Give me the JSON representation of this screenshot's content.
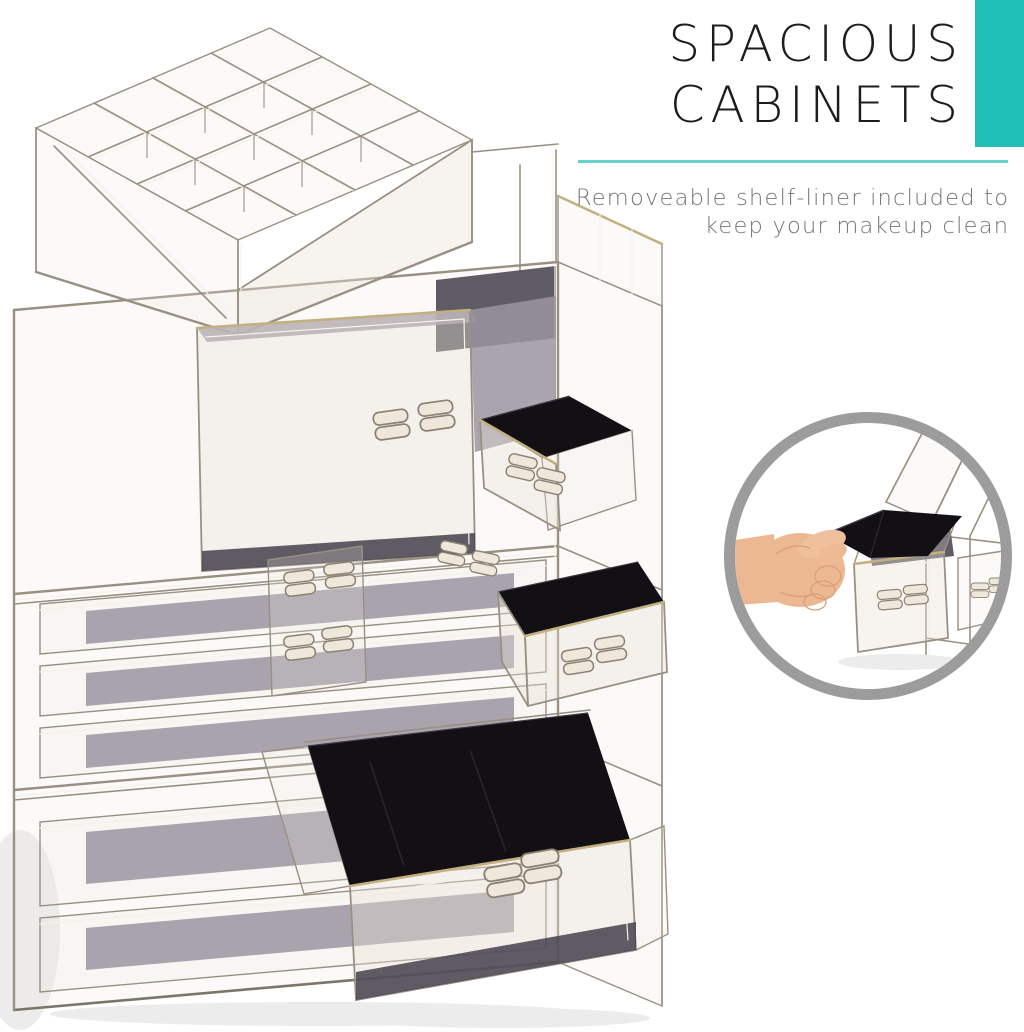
{
  "header": {
    "title_line1": "SPACIOUS",
    "title_line2": "CABINETS",
    "subtitle_line1": "Removeable shelf-liner included to",
    "subtitle_line2": "keep your makeup clean"
  },
  "theme": {
    "accent_teal": "#1fc0b8",
    "divider_teal": "#66d0ca",
    "title_color": "#1c1c1e",
    "subtitle_color": "#71767a",
    "inset_ring": "#9c9c9c",
    "background": "#ffffff",
    "acrylic_edge": "#9a9082",
    "acrylic_highlight": "#f6f2e9",
    "gold_edge": "#c3b081",
    "smoke_panel_light": "#9a94a1",
    "smoke_panel_dark": "#4a4651",
    "felt_black": "#121015",
    "skin_tone": "#ecb892"
  },
  "icons": {
    "product_illustration": "acrylic-makeup-organizer",
    "inset_illustration": "hand-pulling-shelf-liner"
  }
}
